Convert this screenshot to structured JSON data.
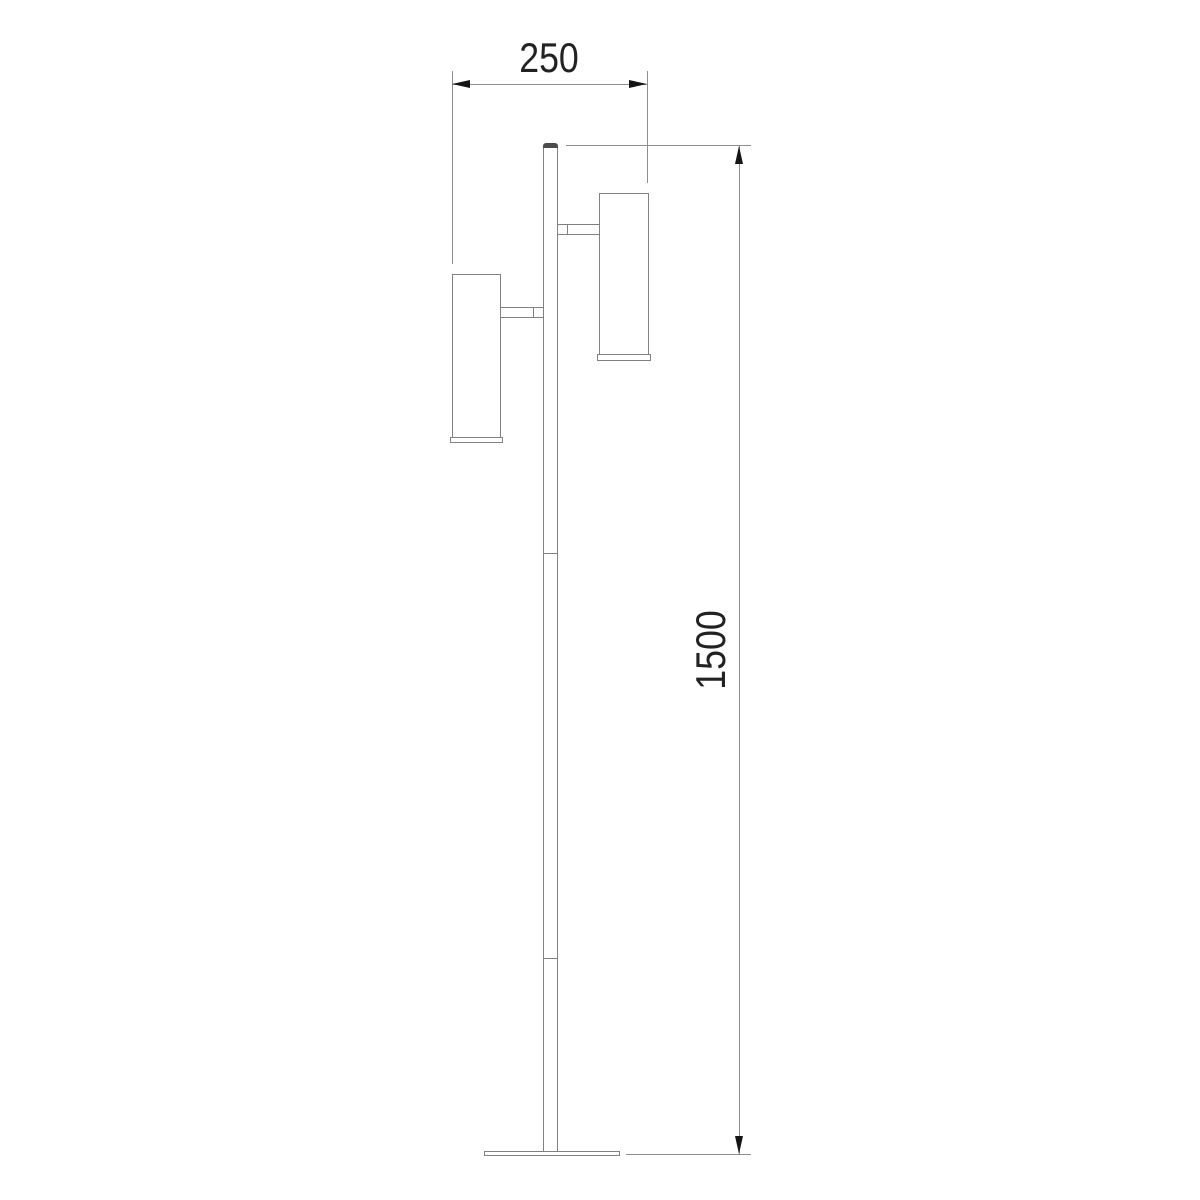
{
  "drawing": {
    "title": "floor-lamp-dimension-drawing",
    "dimensions": {
      "width_label": "250",
      "height_label": "1500"
    },
    "colors": {
      "background": "#ffffff",
      "object_line": "#818181",
      "dimension_line": "#8f8f8f",
      "arrow": "#151515",
      "text": "#222222",
      "cap_fill": "#4c4c4c"
    }
  }
}
